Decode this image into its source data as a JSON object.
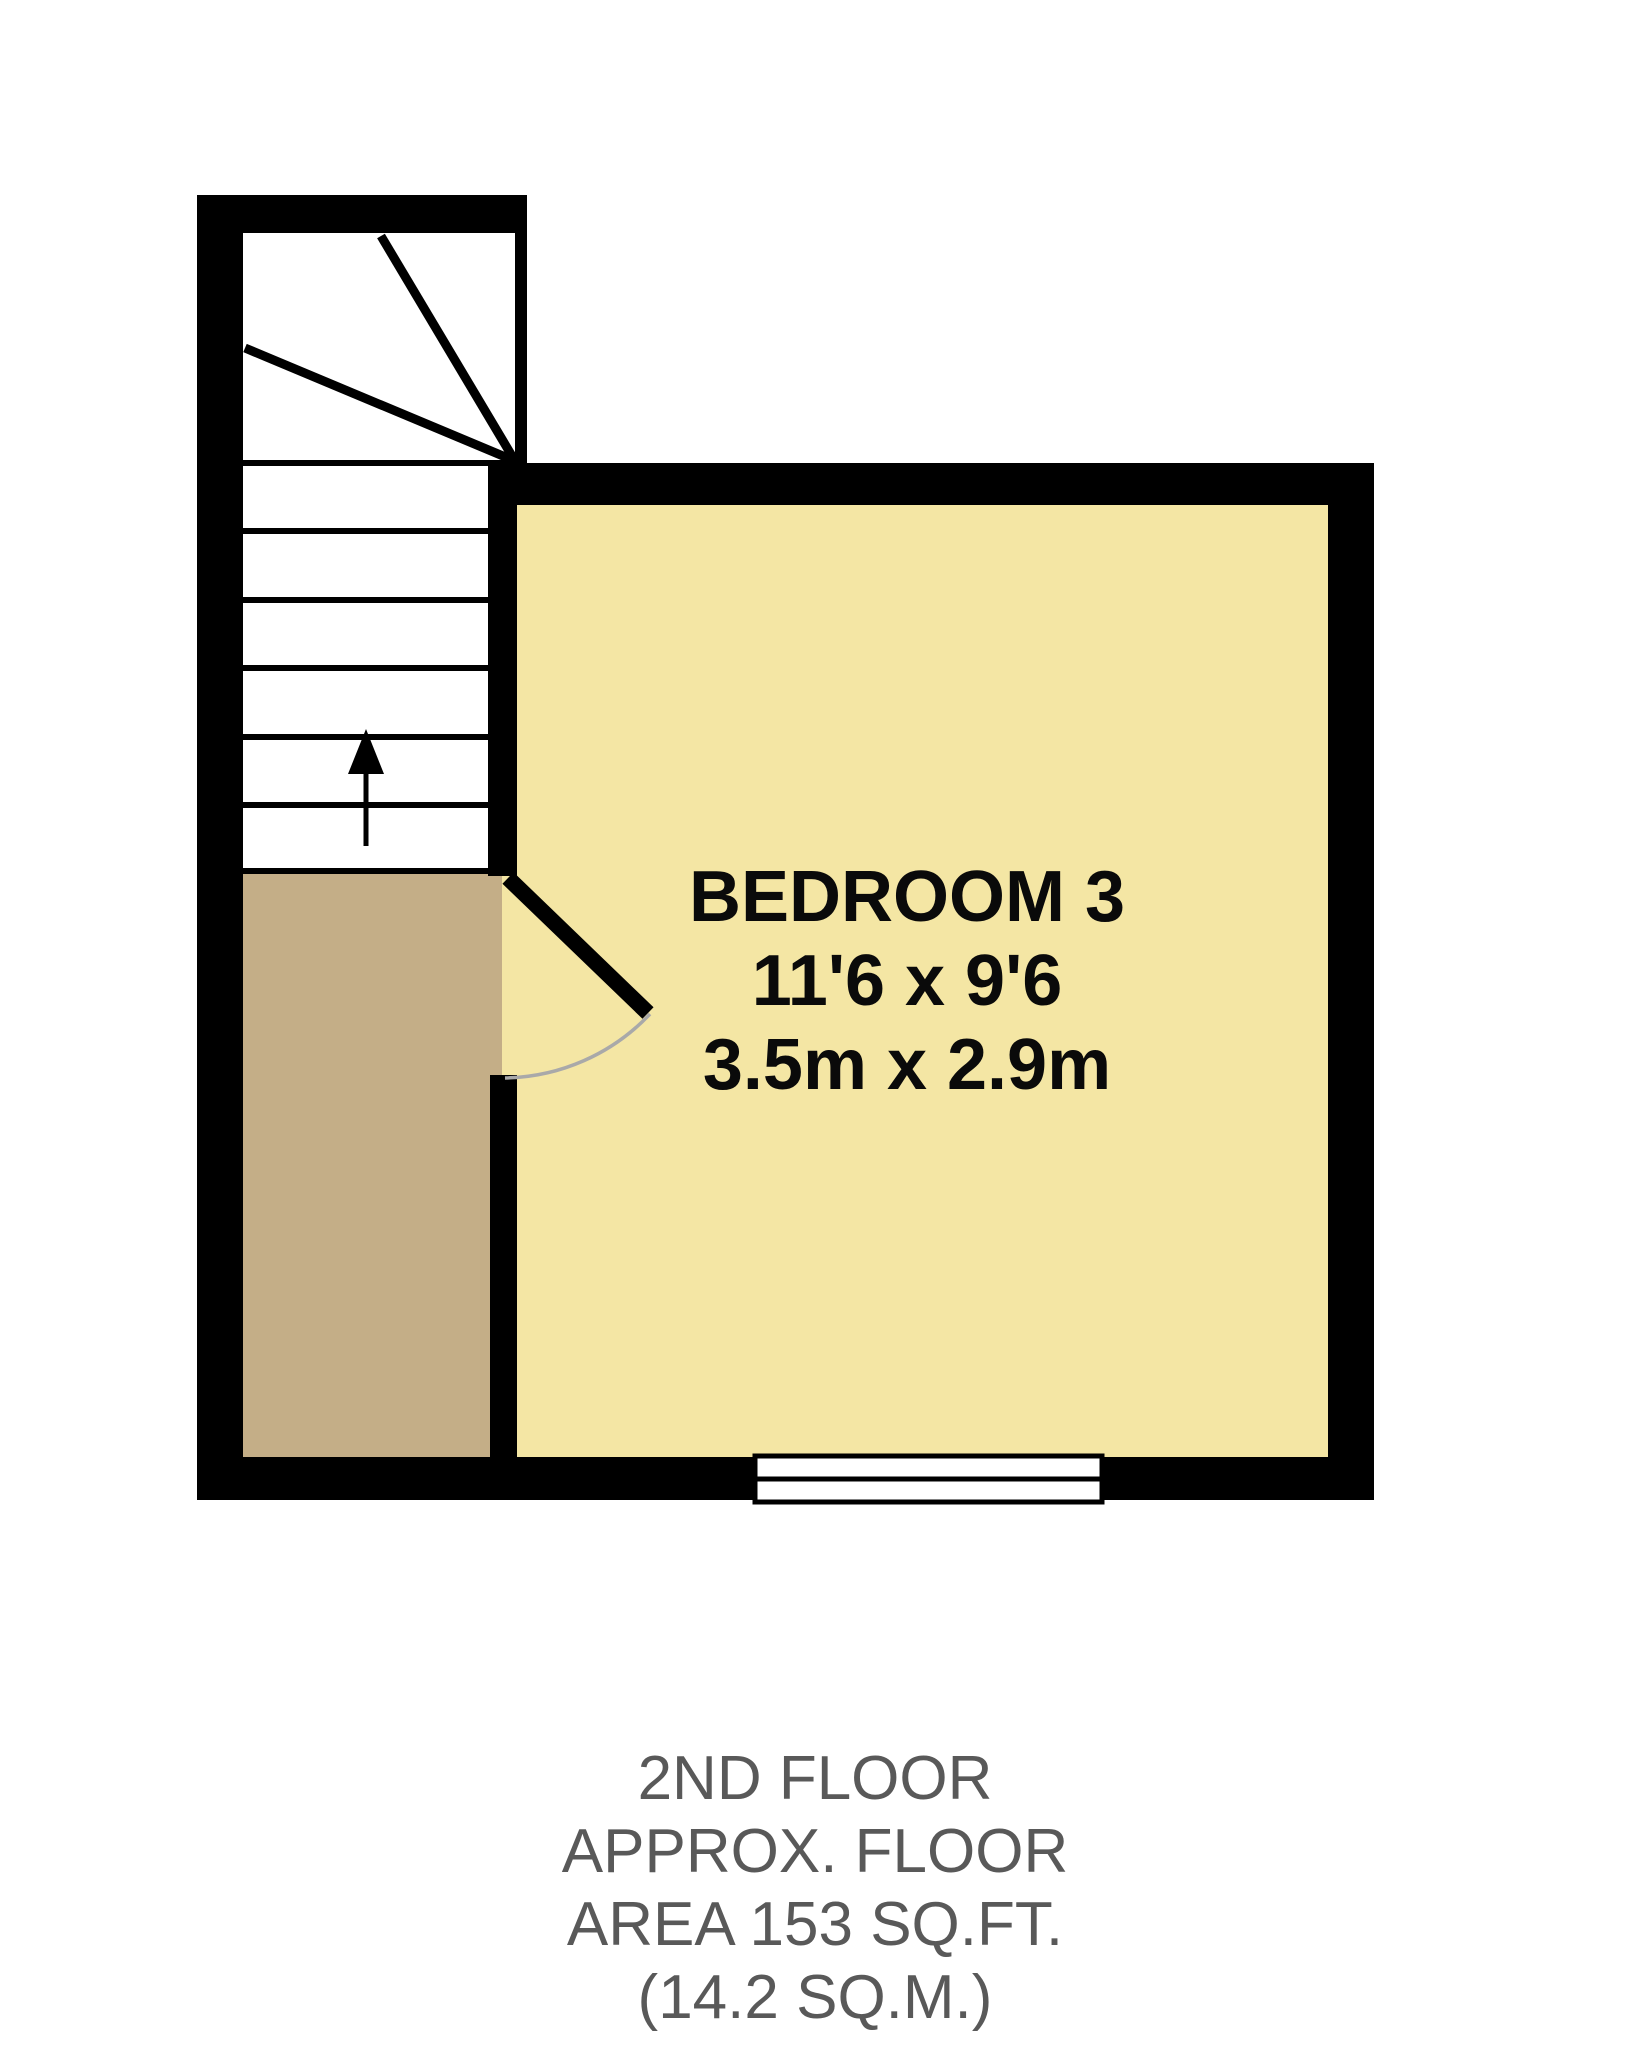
{
  "floorplan": {
    "room": {
      "name": "BEDROOM 3",
      "dimensions_imperial": "11'6 x 9'6",
      "dimensions_metric": "3.5m x 2.9m"
    },
    "caption": {
      "line1": "2ND FLOOR",
      "line2": "APPROX. FLOOR",
      "line3": "AREA 153 SQ.FT.",
      "line4": "(14.2 SQ.M.)"
    },
    "features": {
      "stairs": "winder staircase with up arrow",
      "door": "door swinging into bedroom from landing",
      "window": "window on bottom wall of bedroom"
    },
    "icons": {
      "stairs_up_arrow": "up-arrow-icon"
    },
    "colors": {
      "room_fill": "#F4E6A4",
      "landing_fill": "#C4AE87",
      "wall": "#000000",
      "room_text": "#0A0A0A",
      "caption_text": "#595959",
      "door_arc": "#A9A9A9",
      "background": "#FFFFFF"
    }
  }
}
